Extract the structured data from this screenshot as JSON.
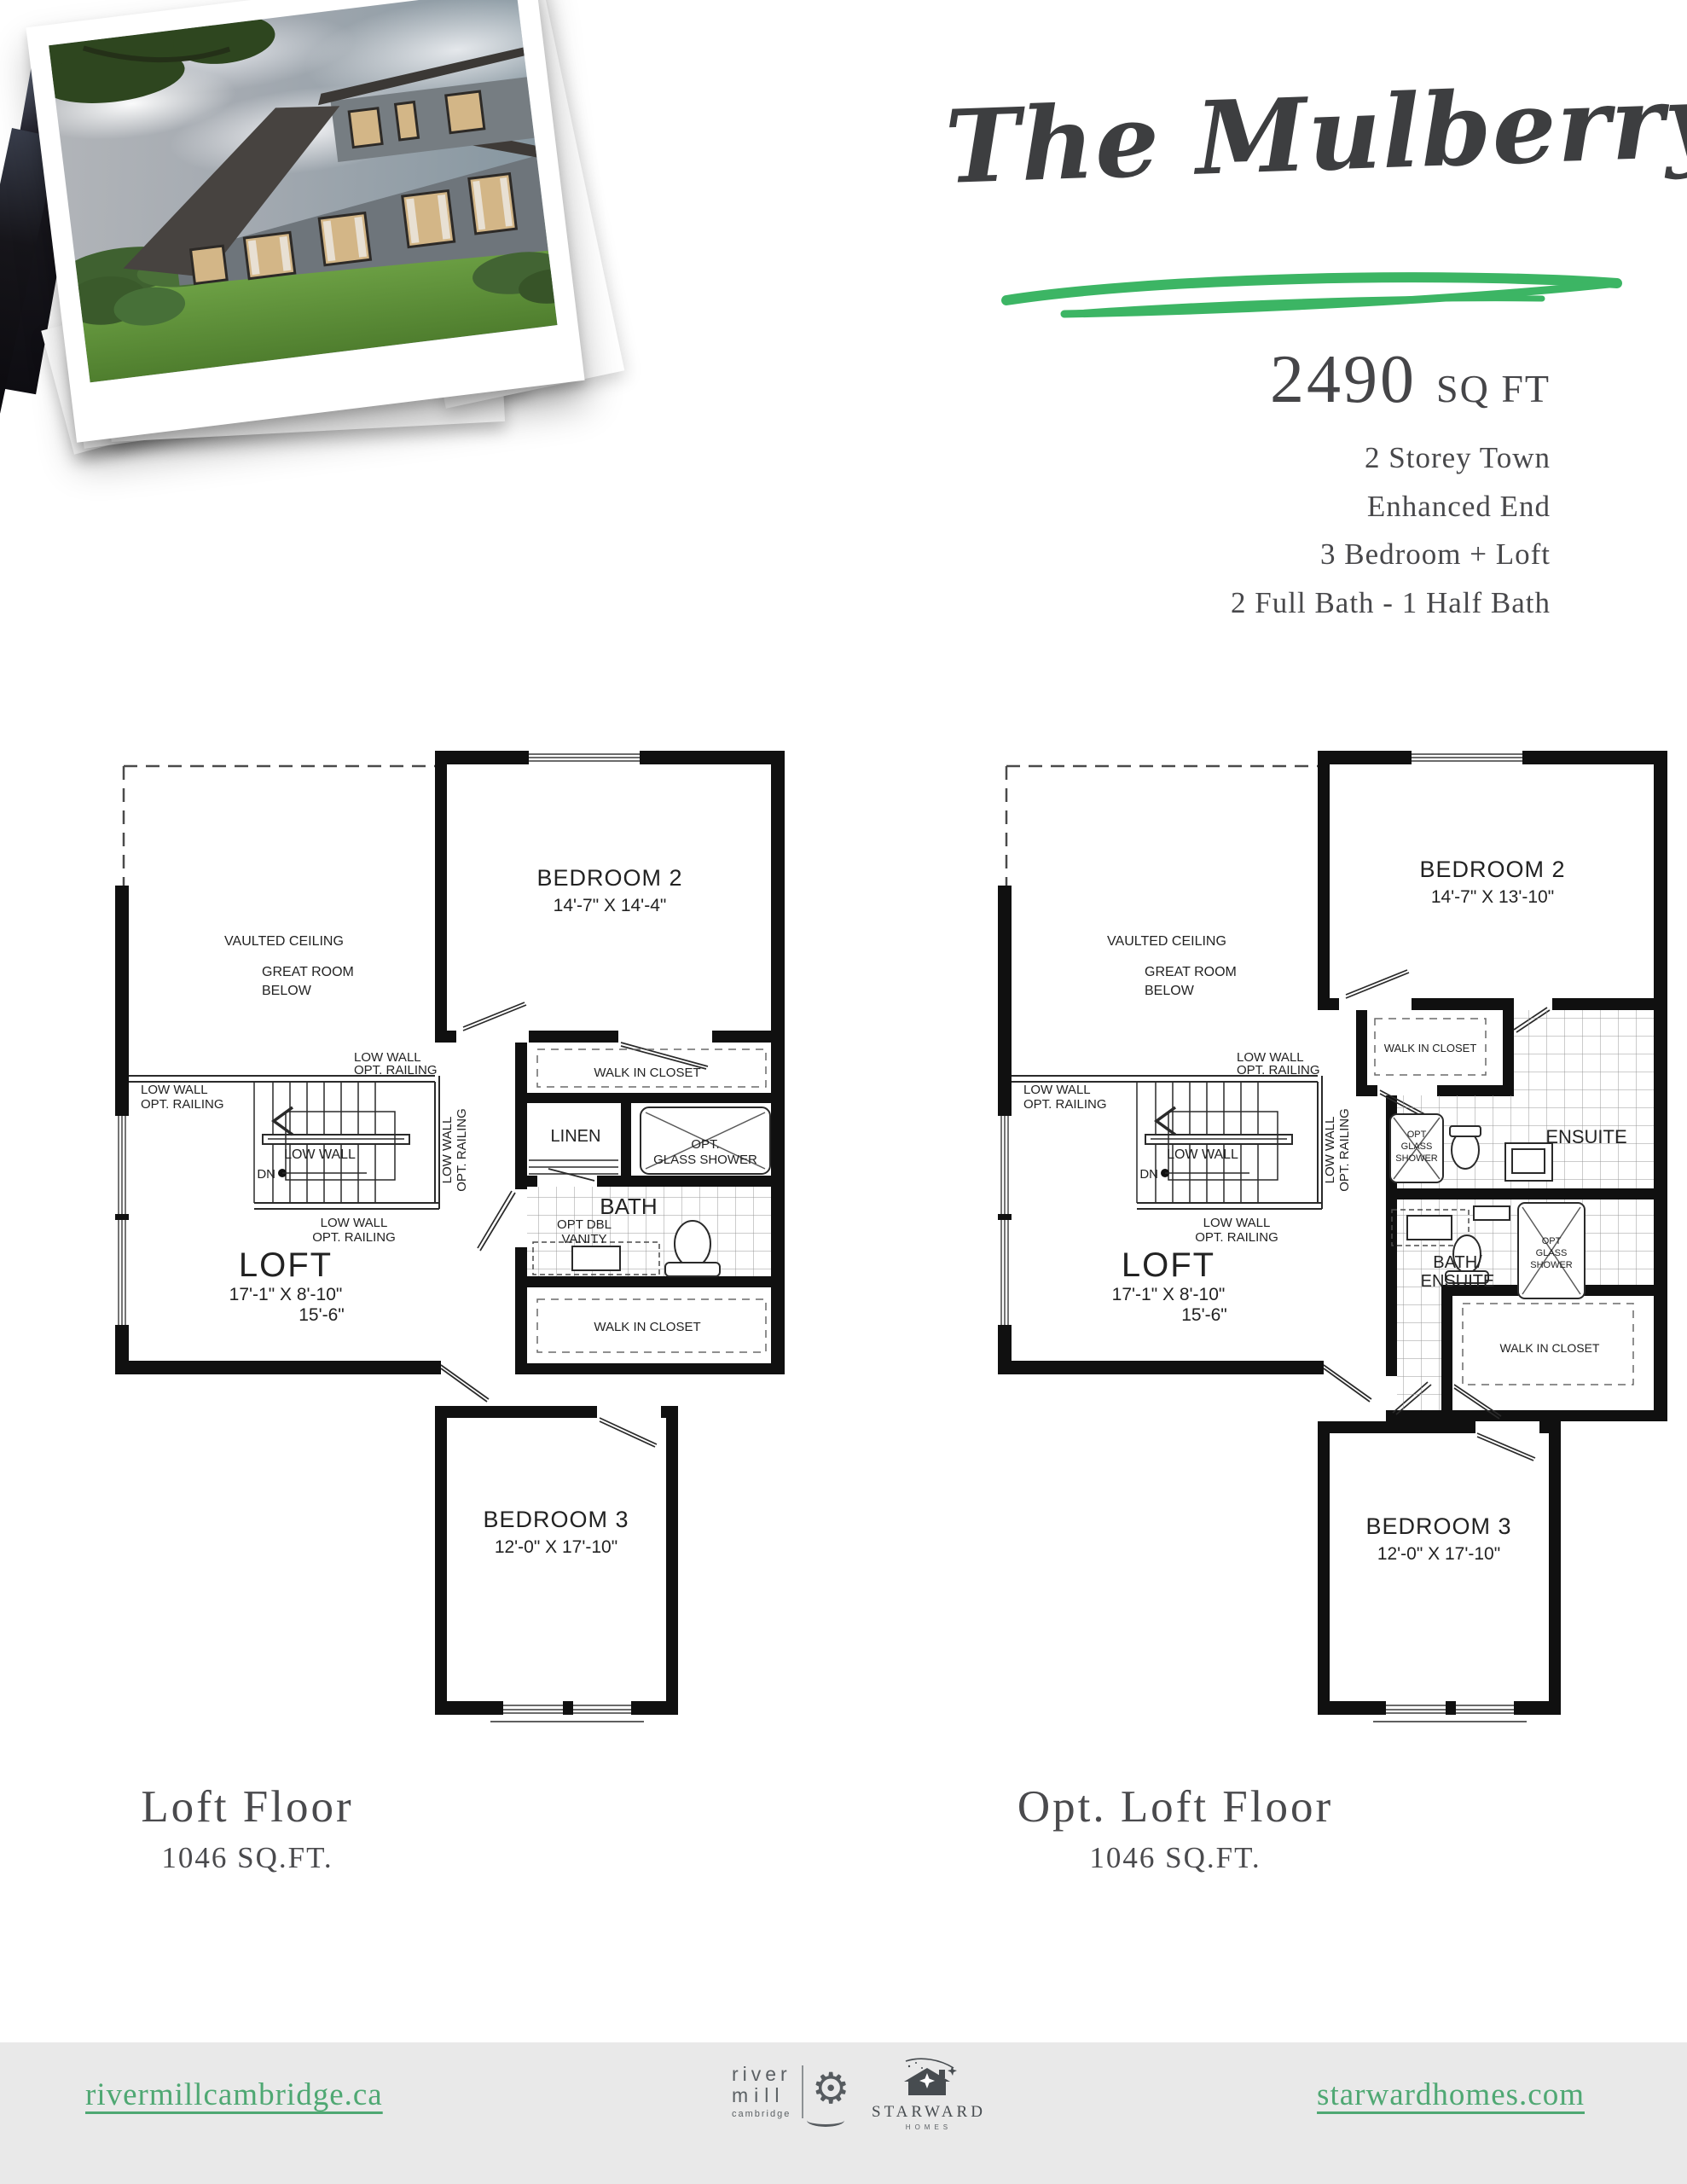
{
  "hero": {
    "title": "The Mulberry",
    "sqft_value": "2490",
    "sqft_unit": "SQ FT",
    "specs": [
      "2 Storey Town",
      "Enhanced End",
      "3 Bedroom + Loft",
      "2 Full Bath - 1 Half Bath"
    ],
    "accent_green": "#3cb564",
    "title_color": "#3d3e40"
  },
  "plans": [
    {
      "caption_title": "Loft Floor",
      "caption_sqft": "1046 SQ.FT.",
      "labels": {
        "vaulted_ceiling": "VAULTED CEILING",
        "great_room": "GREAT ROOM",
        "below": "BELOW",
        "low_wall": "LOW WALL",
        "opt_railing": "OPT. RAILING",
        "dn": "DN",
        "loft": "LOFT",
        "loft_dims_1": "17'-1\" X 8'-10\"",
        "loft_dims_2": "15'-6\"",
        "bedroom2": "BEDROOM 2",
        "bedroom2_dims": "14'-7\" X 14'-4\"",
        "wic_upper": "WALK IN CLOSET",
        "linen": "LINEN",
        "shower_opt": "OPT.",
        "shower_glass": "GLASS SHOWER",
        "bath": "BATH",
        "vanity_1": "OPT DBL",
        "vanity_2": "VANITY",
        "wic_lower": "WALK IN CLOSET",
        "bedroom3": "BEDROOM 3",
        "bedroom3_dims": "12'-0\" X 17'-10\""
      }
    },
    {
      "caption_title": "Opt. Loft Floor",
      "caption_sqft": "1046 SQ.FT.",
      "labels": {
        "vaulted_ceiling": "VAULTED CEILING",
        "great_room": "GREAT ROOM",
        "below": "BELOW",
        "low_wall": "LOW WALL",
        "opt_railing": "OPT. RAILING",
        "dn": "DN",
        "loft": "LOFT",
        "loft_dims_1": "17'-1\" X 8'-10\"",
        "loft_dims_2": "15'-6\"",
        "bedroom2": "BEDROOM 2",
        "bedroom2_dims": "14'-7\" X 13'-10\"",
        "wic_upper": "WALK IN CLOSET",
        "ensuite": "ENSUITE",
        "shower_opt": "OPT",
        "shower_glass": "GLASS",
        "shower_shower": "SHOWER",
        "bath_ensuite_1": "BATH/",
        "bath_ensuite_2": "ENSUITE",
        "wic_lower": "WALK IN CLOSET",
        "bedroom3": "BEDROOM 3",
        "bedroom3_dims": "12'-0\" X 17'-10\""
      }
    }
  ],
  "footer": {
    "left_link": "rivermillcambridge.ca",
    "right_link": "starwardhomes.com",
    "rivermill": {
      "line1": "river",
      "line2": "mill",
      "line3": "cambridge"
    },
    "starward": {
      "name": "STARWARD",
      "sub": "HOMES"
    }
  }
}
